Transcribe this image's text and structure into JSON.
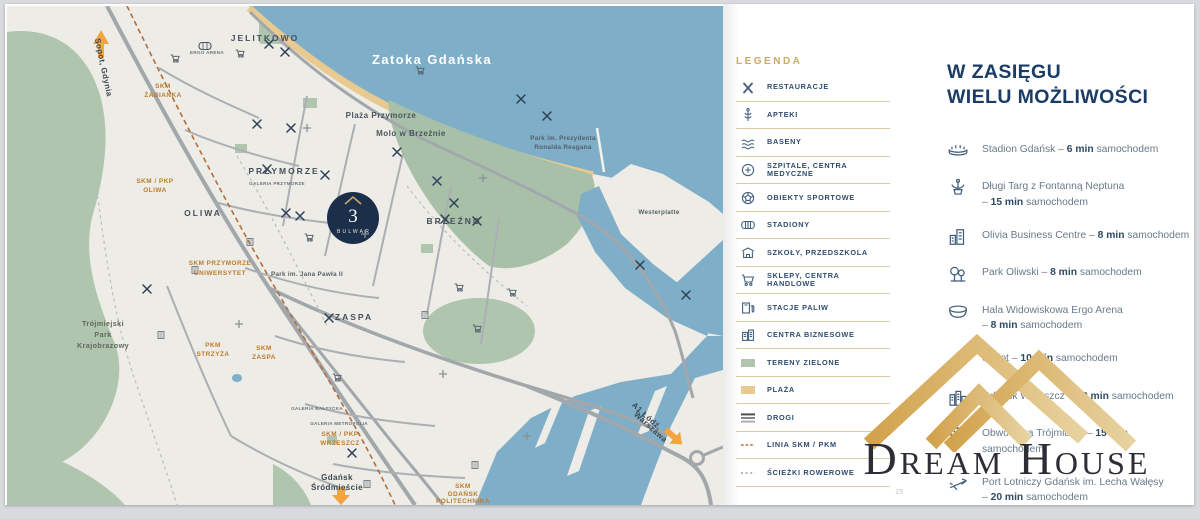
{
  "page_number": "15",
  "branding": {
    "logo_text": "Dream House"
  },
  "colors": {
    "navy": "#1B3C66",
    "gold": "#C8A968",
    "sea": "#7FAEC9",
    "green": "#AFC5AE",
    "beach": "#E8C98F",
    "orange": "#F2A440",
    "station_orange": "#BE7B2C"
  },
  "map": {
    "dev_logo": {
      "number": "3",
      "name": "BULWAR"
    },
    "labels": [
      {
        "t": "Zatoka Gdańska",
        "x": 425,
        "y": 58,
        "c": "sea",
        "n": "sea-label"
      },
      {
        "t": "Plaża Przymorze",
        "x": 374,
        "y": 112,
        "c": "place",
        "n": "beach-label"
      },
      {
        "t": "Molo w Brzeźnie",
        "x": 404,
        "y": 130,
        "c": "place",
        "n": "pier-label"
      },
      {
        "t": "JELITKOWO",
        "x": 258,
        "y": 35,
        "c": "district",
        "n": "district-jelitkowo"
      },
      {
        "t": "PRZYMORZE",
        "x": 277,
        "y": 168,
        "c": "district",
        "n": "district-przymorze"
      },
      {
        "t": "GALERIA PRZYMORZE",
        "x": 270,
        "y": 179,
        "c": "tiny",
        "n": "poi-galeria-przymorze"
      },
      {
        "t": "OLIWA",
        "x": 196,
        "y": 210,
        "c": "district",
        "n": "district-oliwa"
      },
      {
        "t": "BRZEŹNO",
        "x": 447,
        "y": 218,
        "c": "district",
        "n": "district-brzezno"
      },
      {
        "t": "ZASPA",
        "x": 347,
        "y": 314,
        "c": "district",
        "n": "district-zaspa"
      },
      {
        "t": "Westerplatte",
        "x": 652,
        "y": 208,
        "c": "splace",
        "n": "poi-westerplatte"
      },
      {
        "t": "Park im. Jana Pawła II",
        "x": 300,
        "y": 270,
        "c": "splace",
        "n": "poi-park-jana-pawla"
      },
      {
        "t": "Park im. Prezydenta",
        "x": 556,
        "y": 134,
        "c": "splace",
        "n": "poi-park-reagana"
      },
      {
        "t": "Ronalda Reagana",
        "x": 556,
        "y": 143,
        "c": "splace",
        "n": "poi-park-reagana-2"
      },
      {
        "t": "Trójmiejski",
        "x": 96,
        "y": 320,
        "c": "park",
        "n": "poi-tpk-1"
      },
      {
        "t": "Park",
        "x": 96,
        "y": 331,
        "c": "park",
        "n": "poi-tpk-2"
      },
      {
        "t": "Krajobrazowy",
        "x": 96,
        "y": 342,
        "c": "park",
        "n": "poi-tpk-3"
      },
      {
        "t": "SKM",
        "x": 156,
        "y": 82,
        "c": "station",
        "n": "station-zabianka-1"
      },
      {
        "t": "ŻABIANKA",
        "x": 156,
        "y": 91,
        "c": "station",
        "n": "station-zabianka-2"
      },
      {
        "t": "SKM / PKP",
        "x": 148,
        "y": 177,
        "c": "station",
        "n": "station-oliwa-1"
      },
      {
        "t": "OLIWA",
        "x": 148,
        "y": 186,
        "c": "station",
        "n": "station-oliwa-2"
      },
      {
        "t": "SKM PRZYMORZE",
        "x": 213,
        "y": 259,
        "c": "station",
        "n": "station-uniwersytet-1"
      },
      {
        "t": "UNIWERSYTET",
        "x": 213,
        "y": 269,
        "c": "station",
        "n": "station-uniwersytet-2"
      },
      {
        "t": "PKM",
        "x": 206,
        "y": 341,
        "c": "station",
        "n": "station-strzyza-1"
      },
      {
        "t": "STRZYŻA",
        "x": 206,
        "y": 350,
        "c": "station",
        "n": "station-strzyza-2"
      },
      {
        "t": "SKM",
        "x": 257,
        "y": 344,
        "c": "station",
        "n": "station-zaspa-1"
      },
      {
        "t": "ZASPA",
        "x": 257,
        "y": 353,
        "c": "station",
        "n": "station-zaspa-2"
      },
      {
        "t": "GALERIA BAŁTYCKA",
        "x": 310,
        "y": 404,
        "c": "tiny",
        "n": "poi-galeria-baltycka"
      },
      {
        "t": "GALERIA METROPOLIA",
        "x": 332,
        "y": 419,
        "c": "tiny",
        "n": "poi-galeria-metropolia"
      },
      {
        "t": "SKM / PKP",
        "x": 333,
        "y": 430,
        "c": "station",
        "n": "station-wrzeszcz-1"
      },
      {
        "t": "WRZESZCZ",
        "x": 333,
        "y": 439,
        "c": "station",
        "n": "station-wrzeszcz-2"
      },
      {
        "t": "Gdańsk",
        "x": 330,
        "y": 474,
        "c": "dark",
        "n": "label-srodmiescie-1"
      },
      {
        "t": "Śródmieście",
        "x": 330,
        "y": 484,
        "c": "dark",
        "n": "label-srodmiescie-2"
      },
      {
        "t": "SKM",
        "x": 456,
        "y": 482,
        "c": "station",
        "n": "station-politechnika-1"
      },
      {
        "t": "GDAŃSK",
        "x": 456,
        "y": 490,
        "c": "station",
        "n": "station-politechnika-2"
      },
      {
        "t": "POLITECHNIKA",
        "x": 456,
        "y": 497,
        "c": "station",
        "n": "station-politechnika-3"
      },
      {
        "t": "Sopot, Gdynia",
        "x": 94,
        "y": 62,
        "c": "dark",
        "r": 78,
        "n": "label-sopot-gdynia"
      },
      {
        "t": "A1 Łódź,",
        "x": 638,
        "y": 412,
        "c": "dark",
        "r": 42,
        "n": "label-a1-1"
      },
      {
        "t": "Warszawa",
        "x": 642,
        "y": 423,
        "c": "dark",
        "r": 42,
        "n": "label-a1-2"
      },
      {
        "t": "ERGO ARENA",
        "x": 200,
        "y": 48,
        "c": "tiny",
        "n": "poi-ergo-arena"
      }
    ]
  },
  "legend": {
    "title": "LEGENDA",
    "items": [
      {
        "icon": "cutlery-icon",
        "label": "RESTAURACJE"
      },
      {
        "icon": "caduceus-icon",
        "label": "APTEKI"
      },
      {
        "icon": "pool-icon",
        "label": "BASENY"
      },
      {
        "icon": "medical-icon",
        "label": "SZPITALE, CENTRA MEDYCZNE"
      },
      {
        "icon": "sport-icon",
        "label": "OBIEKTY SPORTOWE"
      },
      {
        "icon": "stadium-icon",
        "label": "STADIONY"
      },
      {
        "icon": "school-icon",
        "label": "SZKOŁY, PRZEDSZKOLA"
      },
      {
        "icon": "cart-icon",
        "label": "SKLEPY, CENTRA HANDLOWE"
      },
      {
        "icon": "fuel-icon",
        "label": "STACJE PALIW"
      },
      {
        "icon": "business-icon",
        "label": "CENTRA BIZNESOWE"
      },
      {
        "icon": "green-swatch",
        "label": "TERENY ZIELONE"
      },
      {
        "icon": "beach-swatch",
        "label": "PLAŻA"
      },
      {
        "icon": "roads-swatch",
        "label": "DROGI"
      },
      {
        "icon": "skm-line-swatch",
        "label": "LINIA SKM / PKM"
      },
      {
        "icon": "bike-line-swatch",
        "label": "ŚCIEŻKI ROWEROWE"
      }
    ]
  },
  "poi": {
    "title": {
      "line1": "W ZASIĘGU",
      "line2": "WIELU MOŻLIWOŚCI"
    },
    "items": [
      {
        "icon": "stadium-arena-icon",
        "name": "Stadion Gdańsk",
        "time": "6 min",
        "unit": "samochodem",
        "wrap": false
      },
      {
        "icon": "fountain-icon",
        "name": "Długi Targ z Fontanną Neptuna",
        "time": "15 min",
        "unit": "samochodem",
        "wrap": true
      },
      {
        "icon": "offices-icon",
        "name": "Olivia Business Centre",
        "time": "8 min",
        "unit": "samochodem",
        "wrap": false
      },
      {
        "icon": "park-icon",
        "name": "Park Oliwski",
        "time": "8 min",
        "unit": "samochodem",
        "wrap": false
      },
      {
        "icon": "arena-icon",
        "name": "Hala Widowiskowa Ergo Arena",
        "time": "8 min",
        "unit": "samochodem",
        "wrap": true
      },
      {
        "icon": "pier-icon",
        "name": "Sopot",
        "time": "10 min",
        "unit": "samochodem",
        "wrap": false
      },
      {
        "icon": "city-icon",
        "name": "Gdańsk Wrzeszcz",
        "time": "10 min",
        "unit": "samochodem",
        "wrap": false
      },
      {
        "icon": "interchange-icon",
        "name": "Obwodnica Trójmiasta",
        "time": "15 min",
        "unit": "samochodem",
        "wrap": false
      },
      {
        "icon": "plane-icon",
        "name": "Port Lotniczy Gdańsk im. Lecha Wałęsy",
        "time": "20 min",
        "unit": "samochodem",
        "wrap": true
      }
    ]
  }
}
